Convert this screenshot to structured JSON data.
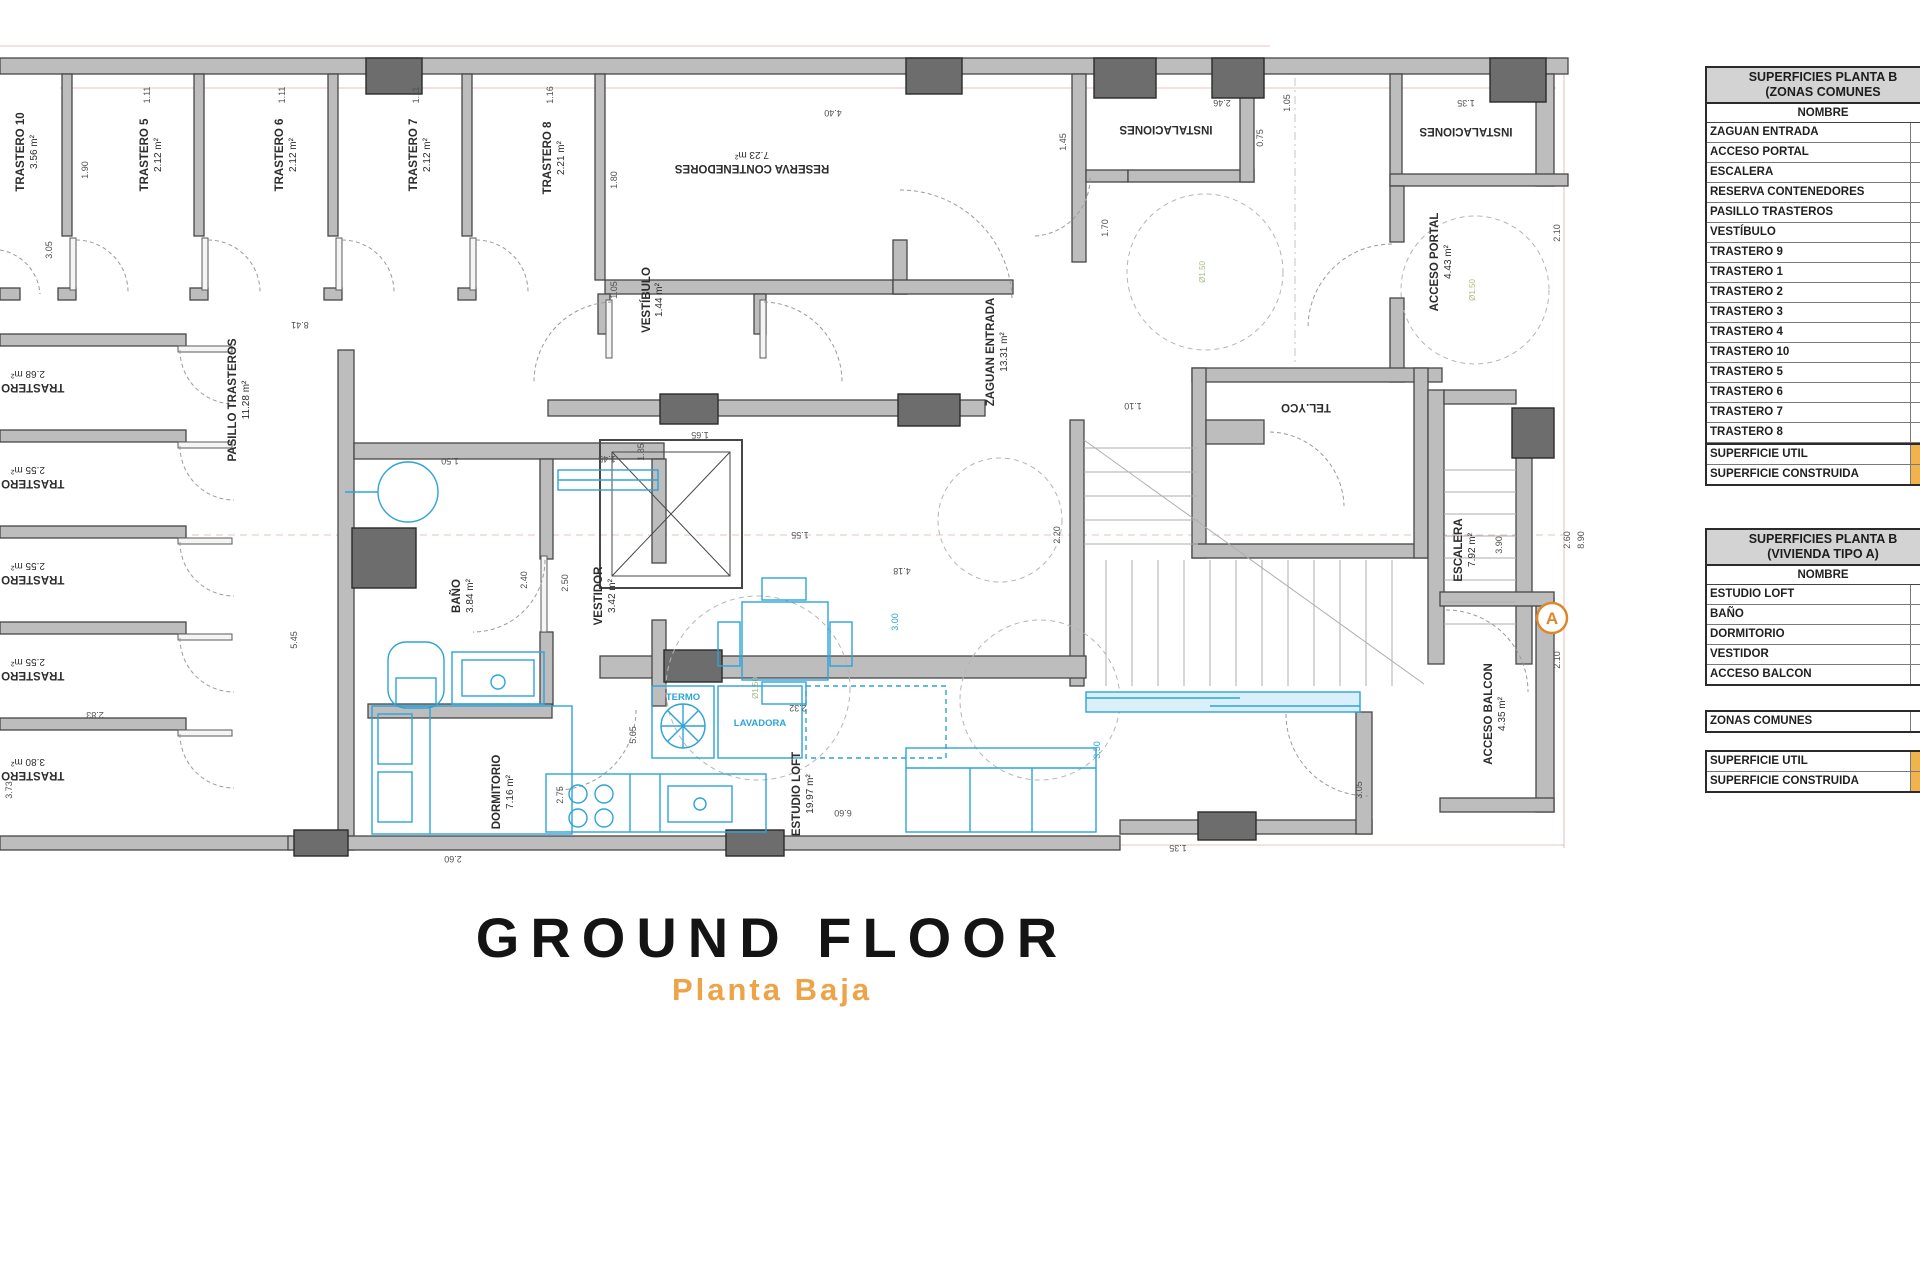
{
  "title": {
    "main": "GROUND FLOOR",
    "sub": "Planta Baja"
  },
  "colors": {
    "wall": "#bdbdbd",
    "wall_stroke": "#474747",
    "pillar": "#6d6d6d",
    "furniture_blue": "#2da3d8",
    "dim_guide_pink": "#dfb0ac",
    "accent_orange": "#e0862a",
    "table_header_gray": "#d3d3d3",
    "value_orange": "#f2b24c"
  },
  "plan": {
    "turn_label": "Ø1.50",
    "marker_a": "A",
    "rooms": {
      "trastero10": {
        "name": "TRASTERO 10",
        "area": "3.56 m²"
      },
      "trastero5": {
        "name": "TRASTERO 5",
        "area": "2.12 m²"
      },
      "trastero6": {
        "name": "TRASTERO 6",
        "area": "2.12 m²"
      },
      "trastero7": {
        "name": "TRASTERO 7",
        "area": "2.12 m²"
      },
      "trastero8": {
        "name": "TRASTERO 8",
        "area": "2.21 m²"
      },
      "reserva": {
        "name": "RESERVA CONTENEDORES",
        "area": "7.23 m²"
      },
      "vestibulo": {
        "name": "VESTÍBULO",
        "area": "1.44 m²"
      },
      "zaguan": {
        "name": "ZAGUAN ENTRADA",
        "area": "13.31 m²"
      },
      "instalaciones1": {
        "name": "INSTALACIONES"
      },
      "instalaciones2": {
        "name": "INSTALACIONES"
      },
      "acceso_portal": {
        "name": "ACCESO PORTAL",
        "area": "4.43 m²"
      },
      "telyco": {
        "name": "TEL.YCO"
      },
      "escalera": {
        "name": "ESCALERA",
        "area": "7.92 m²"
      },
      "pasillo": {
        "name": "PASILLO TRASTEROS",
        "area": "11.28 m²"
      },
      "trastero4": {
        "name": "TRASTERO 4",
        "area": "2.68 m²"
      },
      "trastero3": {
        "name": "TRASTERO 3",
        "area": "2.55 m²"
      },
      "trastero2": {
        "name": "TRASTERO 2",
        "area": "2.55 m²"
      },
      "trastero1": {
        "name": "TRASTERO 1",
        "area": "2.55 m²"
      },
      "trastero9": {
        "name": "TRASTERO 9",
        "area": "3.80 m²"
      },
      "bano": {
        "name": "BAÑO",
        "area": "3.84 m²"
      },
      "vestidor": {
        "name": "VESTIDOR",
        "area": "3.42 m²"
      },
      "dormitorio": {
        "name": "DORMITORIO",
        "area": "7.16 m²"
      },
      "estudio": {
        "name": "ESTUDIO LOFT",
        "area": "19.97 m²"
      },
      "acceso_balcon": {
        "name": "ACCESO BALCON",
        "area": "4.35 m²"
      },
      "termo": "TERMO",
      "lavadora": "LAVADORA"
    },
    "dims": {
      "d1": "1.11",
      "d2": "1.11",
      "d3": "1.11",
      "d4": "1.16",
      "d5": "4.40",
      "d6": "1.90",
      "d7": "3.05",
      "d8": "1.80",
      "d9": "1.05",
      "d10": "8.41",
      "d11": "1.45",
      "d12": "2.46",
      "d13": "0.75",
      "d14": "1.35",
      "d15": "1.05",
      "d16": "1.70",
      "d17": "2.10",
      "d18": "1.10",
      "d19": "2.20",
      "d20": "1.65",
      "d21": "1.50",
      "d22": "1.45",
      "d23": "2.40",
      "d24": "2.50",
      "d25": "1.55",
      "d26": "4.18",
      "d27": "2.32",
      "d28": "5.05",
      "d29": "2.75",
      "d30": "2.60",
      "d31": "5.45",
      "d32": "2.83",
      "d33": "3.73",
      "d34": "6.60",
      "d35": "2.10",
      "d36": "2.60",
      "d37": "8.90",
      "d38": "3.90",
      "d39": "3.05",
      "d40": "3.50",
      "d41": "1.35",
      "d42": "3.00",
      "d43": "1.85"
    }
  },
  "panel": {
    "table_comunes": {
      "title1": "SUPERFICIES PLANTA B",
      "title2": "(ZONAS COMUNES",
      "col": "NOMBRE",
      "rows": [
        "ZAGUAN ENTRADA",
        "ACCESO PORTAL",
        "ESCALERA",
        "RESERVA CONTENEDORES",
        "PASILLO TRASTEROS",
        "VESTÍBULO",
        "TRASTERO 9",
        "TRASTERO 1",
        "TRASTERO 2",
        "TRASTERO 3",
        "TRASTERO 4",
        "TRASTERO 10",
        "TRASTERO 5",
        "TRASTERO 6",
        "TRASTERO 7",
        "TRASTERO 8"
      ],
      "totals": [
        "SUPERFICIE UTIL",
        "SUPERFICIE CONSTRUIDA"
      ]
    },
    "table_vivienda": {
      "title1": "SUPERFICIES PLANTA B",
      "title2": "(VIVIENDA TIPO A)",
      "col": "NOMBRE",
      "rows": [
        "ESTUDIO LOFT",
        "BAÑO",
        "DORMITORIO",
        "VESTIDOR",
        "ACCESO BALCON"
      ]
    },
    "zonas_label": "ZONAS COMUNES",
    "totals": [
      "SUPERFICIE UTIL",
      "SUPERFICIE CONSTRUIDA"
    ]
  }
}
